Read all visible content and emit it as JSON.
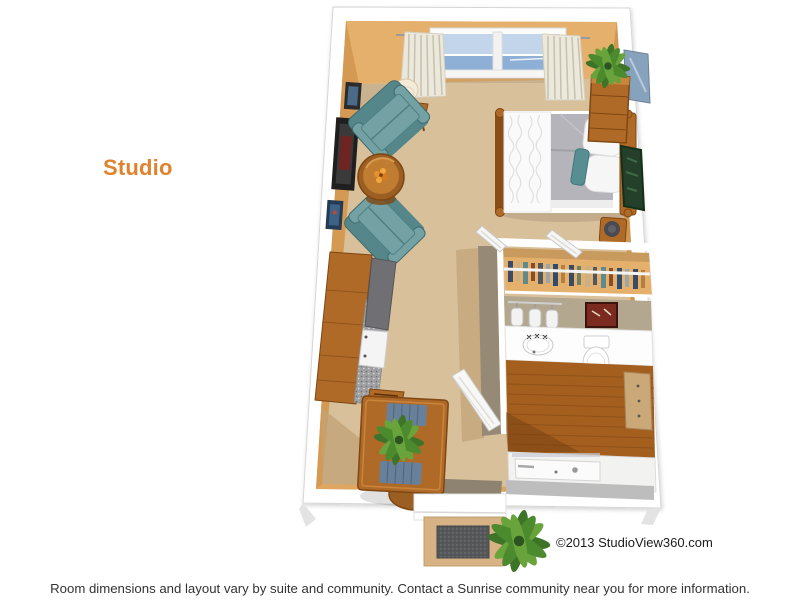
{
  "title": {
    "label": "Studio"
  },
  "watermark": {
    "copyright": "©2013 StudioView360.com"
  },
  "footer": {
    "disclaimer": "Room dimensions and layout vary by suite and community. Contact a Sunrise community near you for more information."
  },
  "colors": {
    "pageBg": "#ffffff",
    "accent": "#e0832d",
    "textDark": "#333333",
    "wallTan": "#dfa660",
    "wallTanLight": "#e5b06c",
    "wallTanDark": "#cf974f",
    "carpet": "#d8c09b",
    "carpetShadow": "#c2a275",
    "taupe": "#91английn"
  },
  "floorplan": {
    "name": "studio-suite-floor-plan",
    "rooms": [
      "living-sleeping-area",
      "kitchenette",
      "bathroom",
      "closet",
      "entry"
    ],
    "furniture": [
      "window-with-curtains",
      "table-lamp",
      "armchairs",
      "round-coffee-table",
      "wall-art",
      "kitchenette-counter",
      "flat-panel",
      "mini-fridge",
      "dining-table-with-plant",
      "dining-chair",
      "bed",
      "bedside-stool",
      "chest-of-drawers-with-plant",
      "right-wall-window",
      "right-wall-art",
      "closet-with-clothes",
      "vanity-lights",
      "bathroom-sink",
      "toilet",
      "linen-cabinet",
      "bathtub",
      "open-door",
      "doormat",
      "entry-plant"
    ]
  }
}
